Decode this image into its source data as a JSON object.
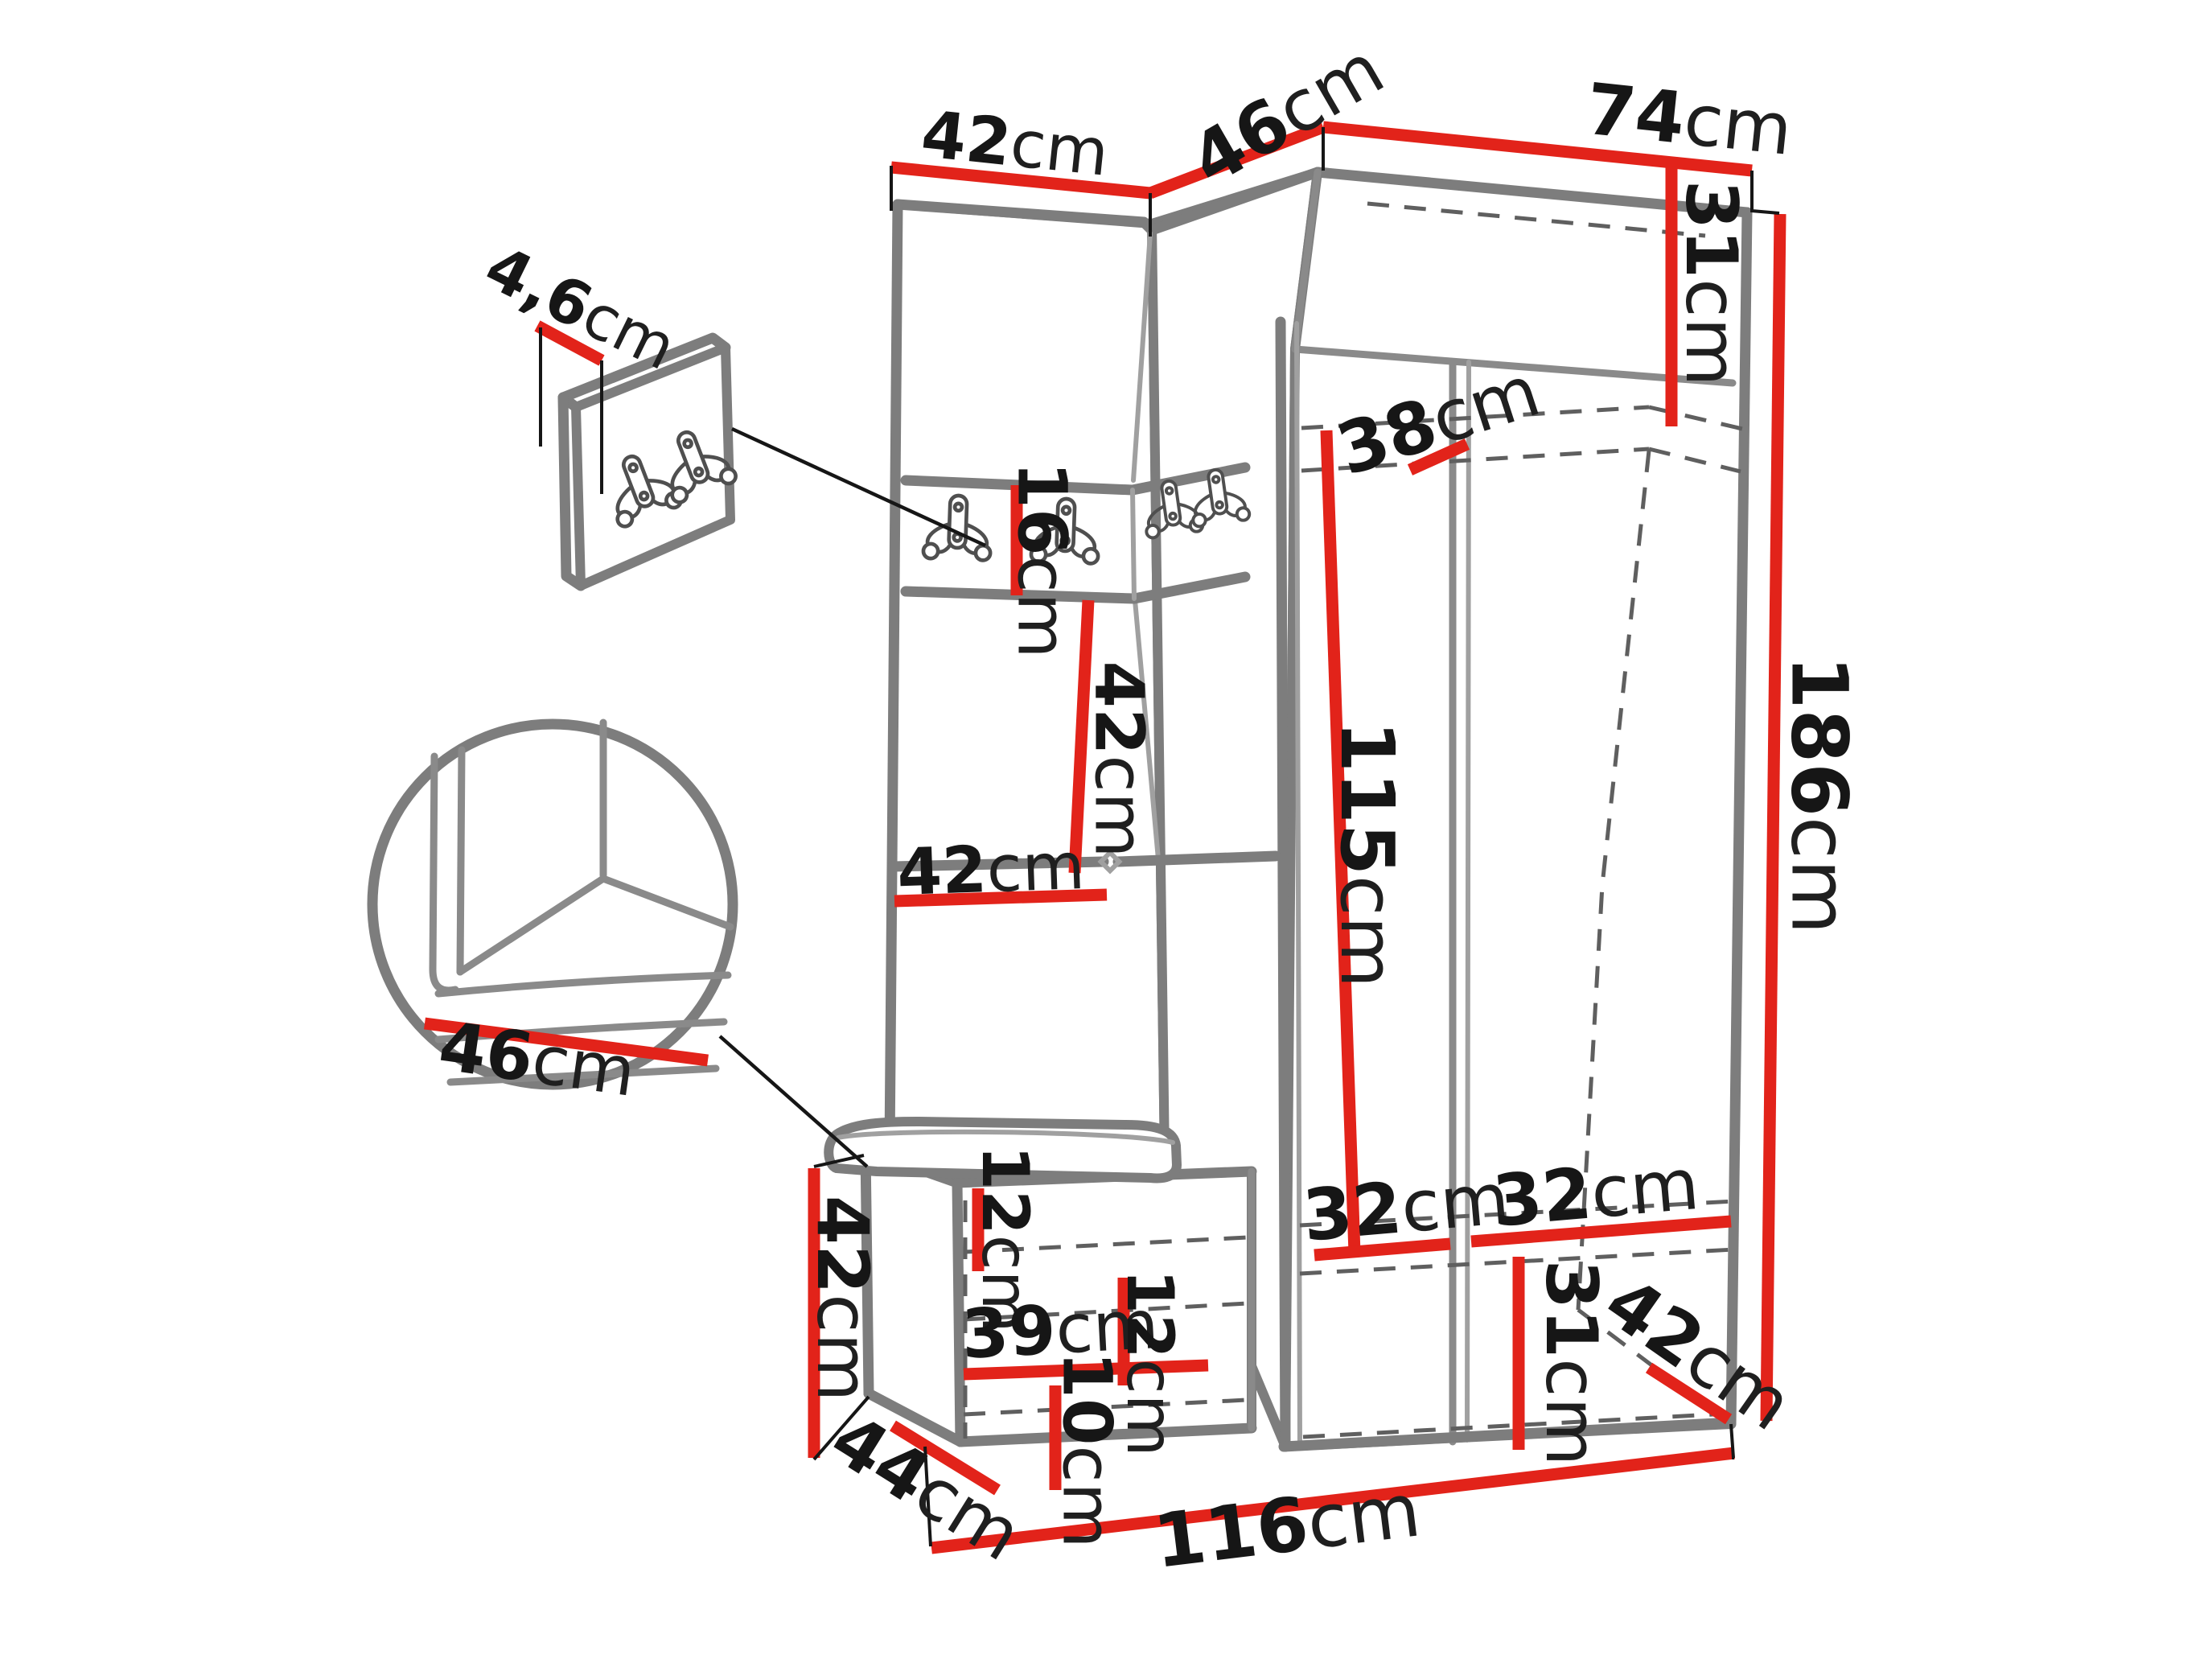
{
  "page": {
    "background": "#ffffff",
    "accent_red": "#e2231a",
    "outline_gray": "#7d7d7d",
    "description": "Hallway furniture set dimension diagram: coat panel, corner section, wardrobe and bench with hook panel and seat details"
  },
  "labels": {
    "top_width_panel": {
      "num": "42",
      "unit": "cm"
    },
    "top_width_corner": {
      "num": "46",
      "unit": "cm"
    },
    "top_width_wardrobe": {
      "num": "74",
      "unit": "cm"
    },
    "panel_thickness": {
      "num": "4,6",
      "unit": "cm"
    },
    "hook_strip_height": {
      "num": "16",
      "unit": "cm"
    },
    "panel_mid_height": {
      "num": "42",
      "unit": "cm"
    },
    "shelf_width": {
      "num": "42",
      "unit": "cm"
    },
    "upper_shelf_height": {
      "num": "31",
      "unit": "cm"
    },
    "interior_depth": {
      "num": "38",
      "unit": "cm"
    },
    "interior_height": {
      "num": "115",
      "unit": "cm"
    },
    "total_height": {
      "num": "186",
      "unit": "cm"
    },
    "seat_width_detail": {
      "num": "46",
      "unit": "cm"
    },
    "bench_height": {
      "num": "42",
      "unit": "cm"
    },
    "bench_depth": {
      "num": "44",
      "unit": "cm"
    },
    "cushion_gap": {
      "num": "12",
      "unit": "cm"
    },
    "bench_shelf_width": {
      "num": "39",
      "unit": "cm"
    },
    "bench_shelf_gap": {
      "num": "12",
      "unit": "cm"
    },
    "bench_bottom_gap": {
      "num": "10",
      "unit": "cm"
    },
    "shoe_shelf_left_width": {
      "num": "32",
      "unit": "cm"
    },
    "shoe_shelf_right_width": {
      "num": "32",
      "unit": "cm"
    },
    "bottom_section_height": {
      "num": "31",
      "unit": "cm"
    },
    "floor_depth": {
      "num": "42",
      "unit": "cm"
    },
    "total_width": {
      "num": "116",
      "unit": "cm"
    }
  }
}
